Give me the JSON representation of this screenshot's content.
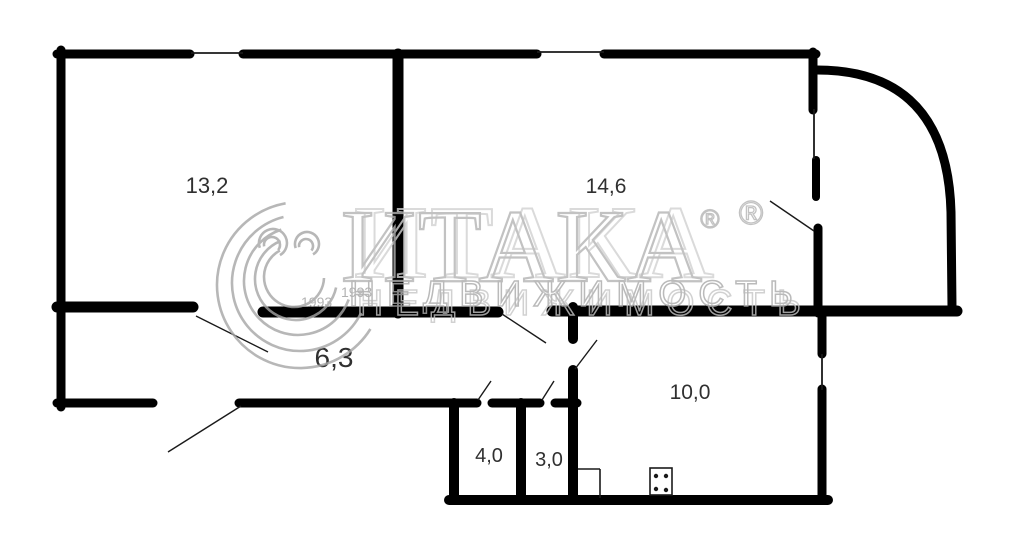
{
  "watermark": {
    "brand": "ИТАКА",
    "reg": "®",
    "subtitle": "НЕДВИЖИМОСТЬ",
    "years": [
      {
        "text": "1993",
        "x": 301,
        "y": 307,
        "size": 14
      },
      {
        "text": "1993",
        "x": 341,
        "y": 297,
        "size": 14
      }
    ],
    "brand_color": "#b4b4b4",
    "brand_ghost_color": "#d2d2d2",
    "subtitle_color": "#a9a9a9",
    "subtitle_ghost_color": "#c6c6c6",
    "logo_arc_color": "#a6a6a6",
    "brand_pos": {
      "x": 341,
      "y": 281,
      "size": 104,
      "spacing": 2,
      "ghost_dx": 12,
      "ghost_dy": -4
    },
    "subtitle_pos": {
      "x": 349,
      "y": 306,
      "size": 36,
      "spacing": 12,
      "ghost_dx": 8,
      "ghost_dy": 9
    },
    "reg_marks": [
      {
        "x": 710,
        "y": 228,
        "size": 26
      },
      {
        "x": 751,
        "y": 224,
        "size": 33
      }
    ],
    "logo_arcs": [
      {
        "cx": 300,
        "cy": 285,
        "r": 83,
        "a0": 100,
        "a1": 328
      },
      {
        "cx": 300,
        "cy": 283,
        "r": 68,
        "a0": 104,
        "a1": 334
      },
      {
        "cx": 298,
        "cy": 281,
        "r": 54,
        "a0": 108,
        "a1": 340
      },
      {
        "cx": 296,
        "cy": 279,
        "r": 41,
        "a0": 112,
        "a1": 348
      },
      {
        "cx": 294,
        "cy": 277,
        "r": 30,
        "a0": 118,
        "a1": 358
      },
      {
        "cx": 273,
        "cy": 243,
        "r": 14,
        "a0": -60,
        "a1": 200
      },
      {
        "cx": 272,
        "cy": 245,
        "r": 8,
        "a0": -40,
        "a1": 190
      },
      {
        "cx": 307,
        "cy": 244,
        "r": 12,
        "a0": -60,
        "a1": 200
      },
      {
        "cx": 306,
        "cy": 246,
        "r": 7,
        "a0": -40,
        "a1": 190
      }
    ]
  },
  "floorplan": {
    "wall_color": "#000000",
    "thin_color": "#1a1a1a",
    "label_color": "#303030",
    "rooms": [
      {
        "id": "13-2",
        "label": "13,2",
        "area_m2": 13.2,
        "x": 207,
        "y": 193,
        "size": 22
      },
      {
        "id": "14-6",
        "label": "14,6",
        "area_m2": 14.6,
        "x": 606,
        "y": 193,
        "size": 21
      },
      {
        "id": "6-3",
        "label": "6,3",
        "area_m2": 6.3,
        "x": 334,
        "y": 367,
        "size": 28
      },
      {
        "id": "10-0",
        "label": "10,0",
        "area_m2": 10.0,
        "x": 690,
        "y": 399,
        "size": 21
      },
      {
        "id": "4-0",
        "label": "4,0",
        "area_m2": 4.0,
        "x": 489,
        "y": 462,
        "size": 20
      },
      {
        "id": "3-0",
        "label": "3,0",
        "area_m2": 3.0,
        "x": 549,
        "y": 466,
        "size": 20
      }
    ],
    "walls": [
      [
        57,
        54,
        190,
        54,
        9
      ],
      [
        243,
        54,
        537,
        54,
        9
      ],
      [
        604,
        54,
        816,
        54,
        9
      ],
      [
        61,
        50,
        61,
        407,
        9
      ],
      [
        813,
        52,
        813,
        110,
        9
      ],
      [
        816,
        160,
        816,
        197,
        8
      ],
      [
        818,
        228,
        818,
        313,
        9
      ],
      [
        57,
        307,
        193,
        307,
        11
      ],
      [
        263,
        312,
        498,
        312,
        11
      ],
      [
        552,
        311,
        957,
        311,
        11
      ],
      [
        398,
        54,
        398,
        313,
        11
      ],
      [
        573,
        307,
        573,
        339,
        10
      ],
      [
        573,
        370,
        573,
        500,
        10
      ],
      [
        822,
        311,
        822,
        354,
        9
      ],
      [
        822,
        389,
        822,
        500,
        9
      ],
      [
        449,
        500,
        828,
        500,
        10
      ],
      [
        454,
        403,
        454,
        498,
        10
      ],
      [
        521,
        403,
        521,
        498,
        10
      ],
      [
        57,
        403,
        153,
        403,
        9
      ],
      [
        239,
        403,
        477,
        403,
        9
      ],
      [
        492,
        403,
        540,
        403,
        9
      ],
      [
        555,
        403,
        577,
        403,
        9
      ]
    ],
    "balcony_arc": "M 817 70 C 888 70 948 102 951 212 L 952 307",
    "windows": [
      [
        191,
        53,
        243,
        53
      ],
      [
        537,
        52,
        604,
        52
      ],
      [
        814,
        109,
        814,
        159
      ],
      [
        822,
        354,
        822,
        390
      ]
    ],
    "door_swings": [
      [
        196,
        316,
        268,
        352
      ],
      [
        502,
        314,
        546,
        343
      ],
      [
        575,
        369,
        597,
        340
      ],
      [
        770,
        201,
        814,
        231
      ],
      [
        241,
        406,
        168,
        452
      ],
      [
        478,
        400,
        491,
        381
      ],
      [
        542,
        400,
        554,
        381
      ]
    ],
    "stove": {
      "x": 650,
      "y": 468,
      "w": 22,
      "h": 27,
      "dot_r": 2.2,
      "dots": [
        [
          656,
          476
        ],
        [
          666,
          476
        ],
        [
          656,
          489
        ],
        [
          666,
          490
        ]
      ]
    },
    "cupboard_lines": [
      [
        578,
        469,
        600,
        469
      ],
      [
        600,
        469,
        600,
        498
      ]
    ]
  }
}
